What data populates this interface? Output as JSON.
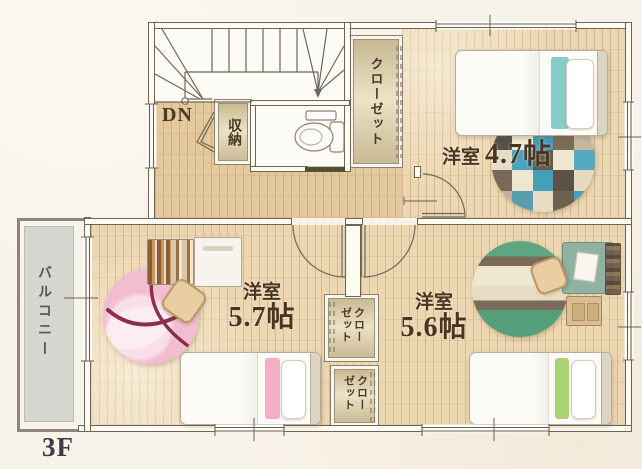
{
  "floor_label": "3F",
  "balcony": {
    "label": "バルコニー"
  },
  "stairs": {
    "label": "DN"
  },
  "storage": {
    "label": "収納"
  },
  "closets": {
    "closet_47": "クローゼット",
    "closet_57": "クローゼット",
    "closet_56": "クローゼット"
  },
  "rooms": {
    "room_47": {
      "type": "洋室",
      "size": "4.7帖"
    },
    "room_57": {
      "type": "洋室",
      "size": "5.7帖"
    },
    "room_56": {
      "type": "洋室",
      "size": "5.6帖"
    }
  },
  "colors": {
    "wall": "#6d6456",
    "wood_floor": "#ecd7b2",
    "hall_floor": "#e4c89e",
    "accent_teal": "#7fc9c4",
    "accent_pink": "#f3abc4",
    "accent_green": "#a5d06c",
    "rug_pink": "#f2bcd1",
    "rug_green": "#5fa582",
    "label_brown": "#4a3521"
  }
}
